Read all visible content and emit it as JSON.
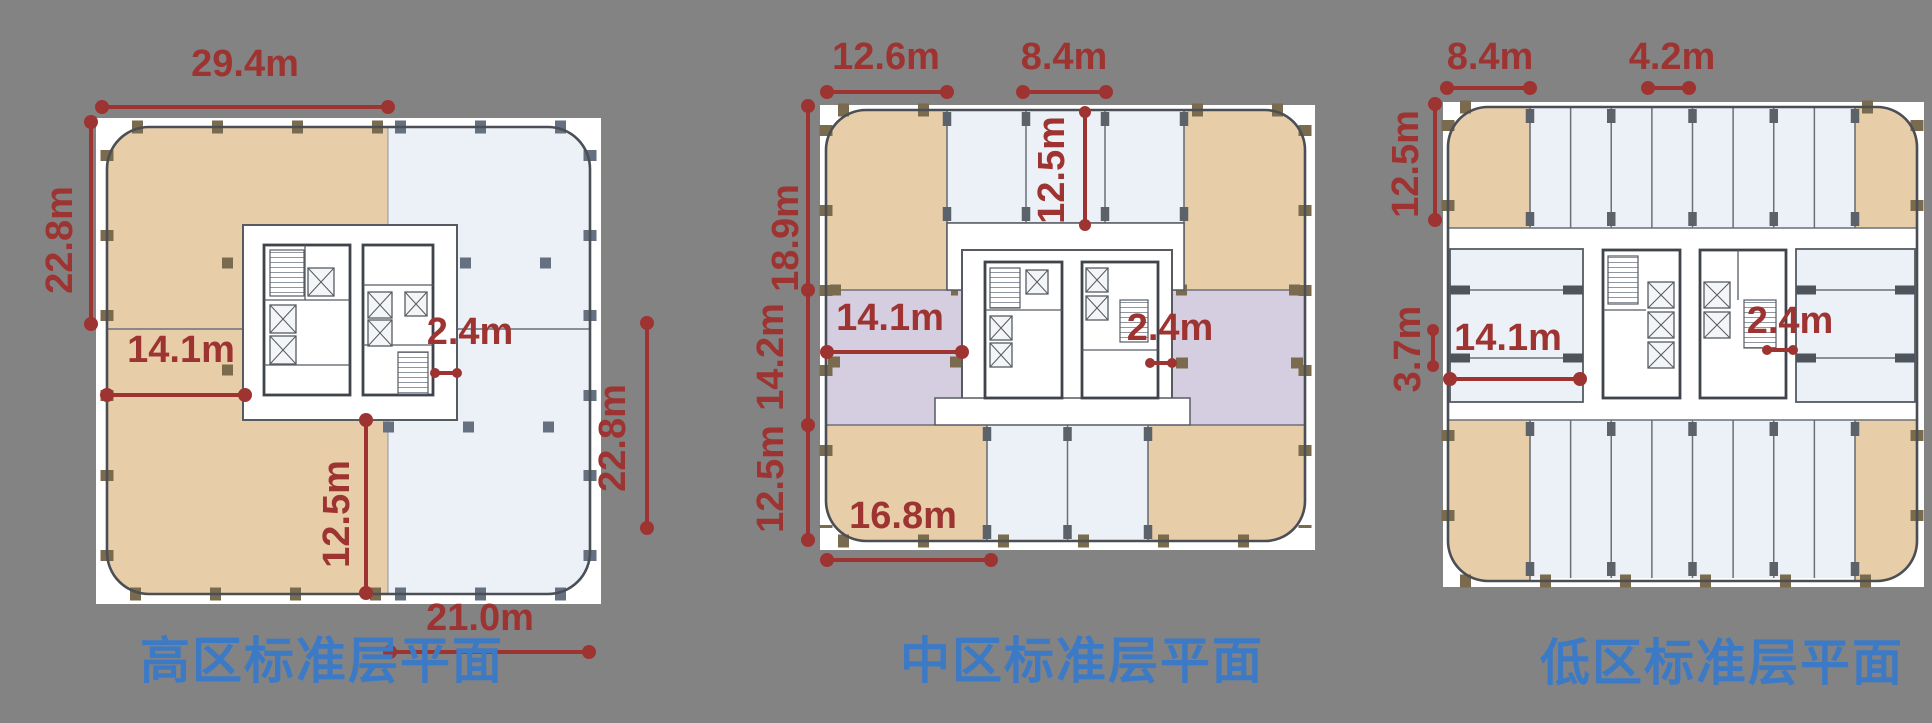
{
  "colors": {
    "background": "#838383",
    "tan": "#e8cda9",
    "blue": "#ecf1f7",
    "purple": "#d5cee0",
    "outline": "#4a4f55",
    "dim": "#9e3432",
    "title": "#3d7ac6"
  },
  "plans": [
    {
      "title": "高区标准层平面",
      "dims": {
        "top": "29.4m",
        "left": "22.8m",
        "wing": "14.1m",
        "core": "2.4m",
        "lower": "12.5m",
        "right": "22.8m",
        "bottom": "21.0m"
      }
    },
    {
      "title": "中区标准层平面",
      "dims": {
        "top_left": "12.6m",
        "top_bay": "8.4m",
        "left_upper": "18.9m",
        "left_mid": "14.2m",
        "left_lower": "12.5m",
        "bay_depth": "12.5m",
        "wing": "14.1m",
        "core": "2.4m",
        "bottom": "16.8m"
      }
    },
    {
      "title": "低区标准层平面",
      "dims": {
        "top_left": "8.4m",
        "bay": "4.2m",
        "left": "12.5m",
        "room": "3.7m",
        "wing": "14.1m",
        "core": "2.4m"
      }
    }
  ]
}
